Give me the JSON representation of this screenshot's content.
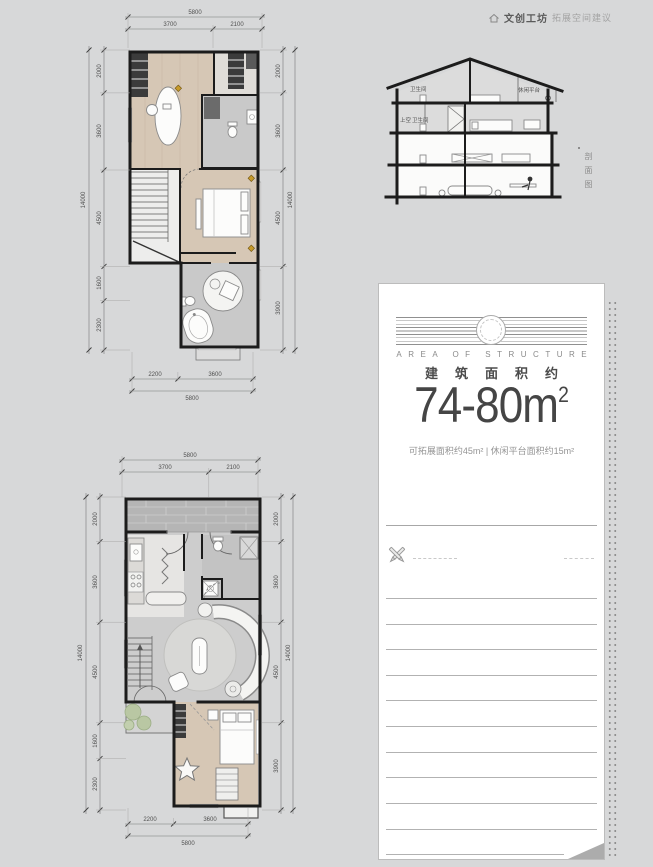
{
  "header": {
    "brand": "文创工坊",
    "subtitle": "拓展空间建议"
  },
  "section": {
    "labels": {
      "bath_top": "卫生间",
      "platform": "休闲平台",
      "void": "上空",
      "bath_mid": "卫生间"
    },
    "side_label": "剖面图"
  },
  "card": {
    "title_en": "AREA OF STRUCTURE",
    "title_cn": "建筑面积约",
    "area_value": "74-80m",
    "area_sup": "2",
    "note": "可拓展面积约45m² | 休闲平台面积约15m²"
  },
  "plan_upper": {
    "top": {
      "total": "5800",
      "segs": [
        "3700",
        "2100"
      ]
    },
    "left": {
      "total": "14000",
      "segs": [
        "2000",
        "3600",
        "4500",
        "1600",
        "2300"
      ]
    },
    "right": {
      "total": "14000",
      "segs": [
        "2000",
        "3600",
        "4500",
        "3900"
      ]
    },
    "bottom": {
      "total": "5800",
      "segs": [
        "2200",
        "3600"
      ]
    }
  },
  "plan_lower": {
    "top": {
      "total": "5800",
      "segs": [
        "3700",
        "2100"
      ]
    },
    "left": {
      "total": "14000",
      "segs": [
        "2000",
        "3600",
        "4500",
        "1600",
        "2300"
      ]
    },
    "right": {
      "total": "14000",
      "segs": [
        "2000",
        "3600",
        "4500",
        "3900"
      ]
    },
    "bottom": {
      "total": "5800",
      "segs": [
        "2200",
        "3600"
      ]
    }
  }
}
